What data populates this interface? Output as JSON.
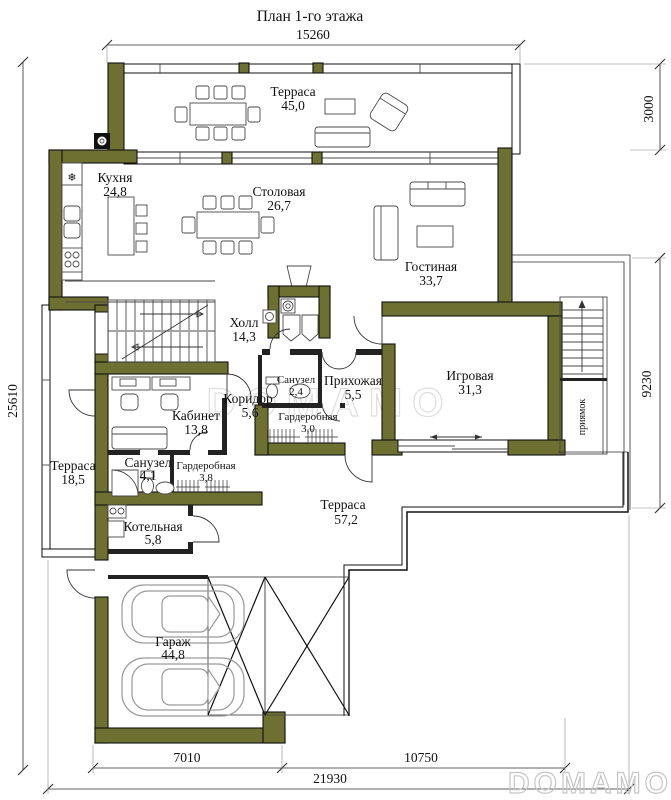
{
  "title": "План 1-го этажа",
  "colors": {
    "wall": "#6d7031",
    "outline": "#1b1b1b",
    "furniture": "#4a4a4a",
    "car_outline": "#9a9a9a",
    "watermark_center": "#dedede",
    "watermark_corner": "#c6c6c6"
  },
  "dimensions": {
    "top": "15260",
    "right_top": "3000",
    "right_side": "9230",
    "left": "25610",
    "bottom_garage": "7010",
    "bottom_terrace": "10750",
    "bottom_total": "21930"
  },
  "annotations": {
    "pit": "приямок"
  },
  "icons": {
    "fridge_snowflake": "❄"
  },
  "watermarks": {
    "center": "DOMAMO",
    "corner": "DOMAMO"
  },
  "rooms": [
    {
      "name": "Терраса",
      "area": "45,0"
    },
    {
      "name": "Кухня",
      "area": "24,8"
    },
    {
      "name": "Столовая",
      "area": "26,7"
    },
    {
      "name": "Гостиная",
      "area": "33,7"
    },
    {
      "name": "Холл",
      "area": "14,3"
    },
    {
      "name": "Кабинет",
      "area": "13,8"
    },
    {
      "name": "Коридор",
      "area": "5,6"
    },
    {
      "name": "Санузел",
      "area": "2,4"
    },
    {
      "name": "Прихожая",
      "area": "5,5"
    },
    {
      "name": "Гардеробная",
      "area": "3,0"
    },
    {
      "name": "Игровая",
      "area": "31,3"
    },
    {
      "name": "Терраса",
      "area": "18,5"
    },
    {
      "name": "Санузел",
      "area": "4,1"
    },
    {
      "name": "Гардеробная",
      "area": "3,8"
    },
    {
      "name": "Котельная",
      "area": "5,8"
    },
    {
      "name": "Терраса",
      "area": "57,2"
    },
    {
      "name": "Гараж",
      "area": "44,8"
    }
  ]
}
